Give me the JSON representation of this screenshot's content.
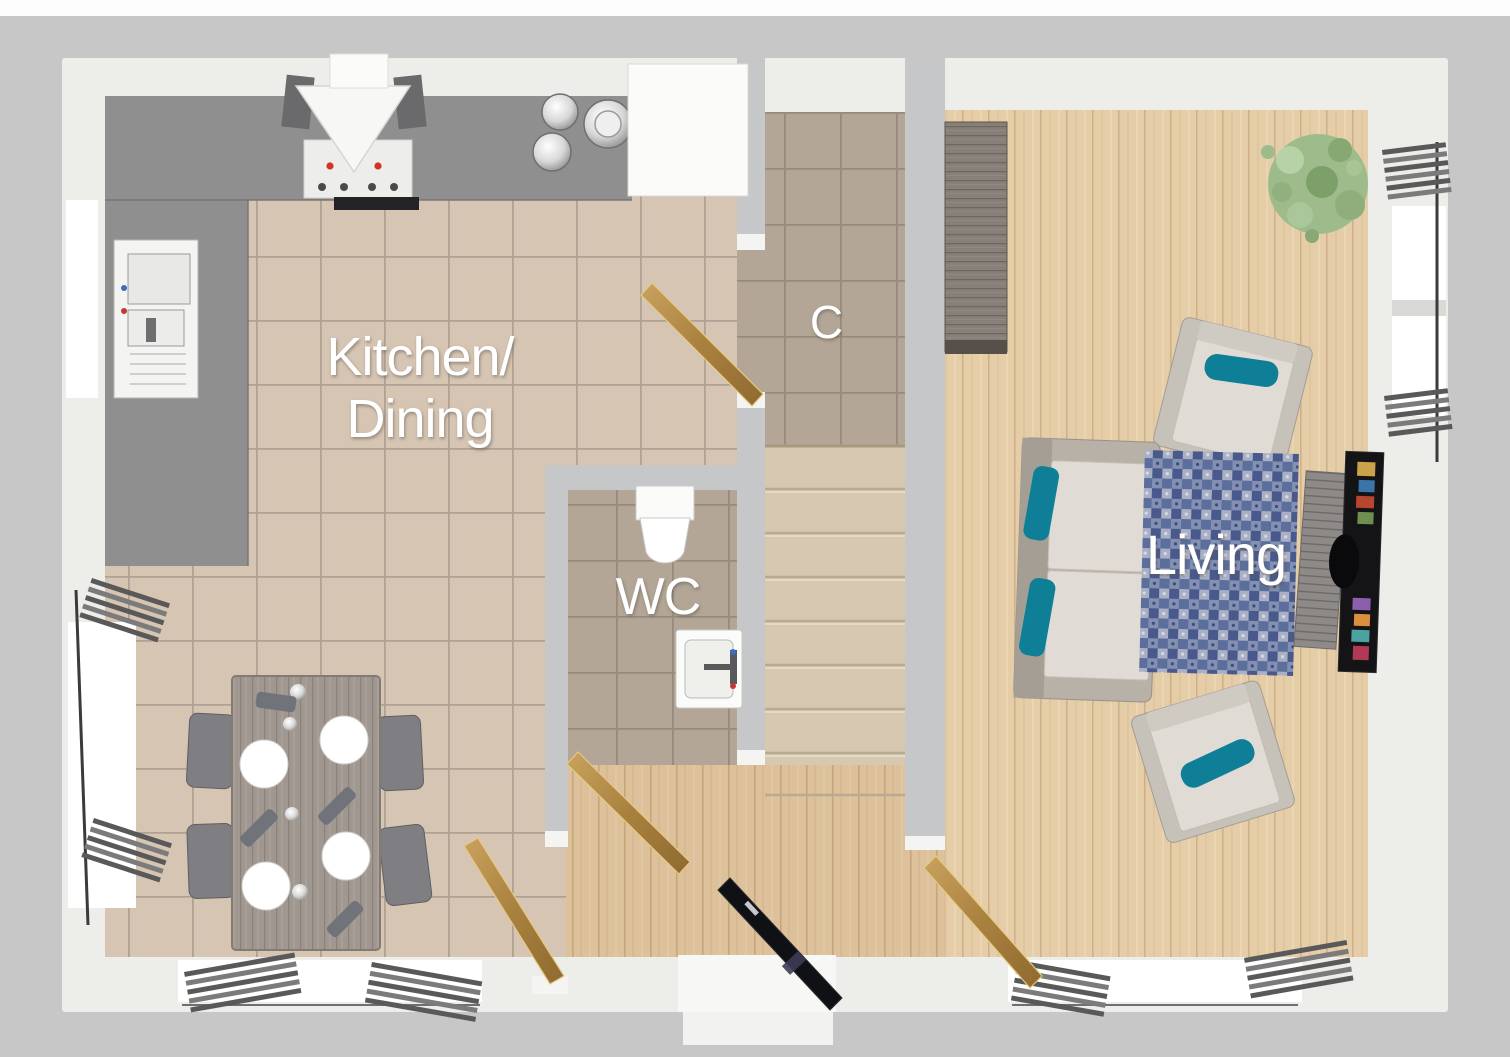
{
  "plan": {
    "view": "3d-top-down-floor-plan",
    "rooms": {
      "kitchen_dining": {
        "label_line1": "Kitchen/",
        "label_line2": "Dining"
      },
      "wc": {
        "label": "WC"
      },
      "cupboard": {
        "label": "C"
      },
      "living": {
        "label": "Living"
      }
    },
    "furniture": {
      "kitchen_dining": [
        "l-shaped-worktop",
        "extractor-hood",
        "hob",
        "sink-bowls",
        "tall-white-cabinet",
        "under-window-sink-unit",
        "dining-table",
        "dining-chairs",
        "plates",
        "radiators",
        "windows"
      ],
      "wc": [
        "toilet",
        "washbasin"
      ],
      "hall": [
        "staircase",
        "front-door",
        "internal-doors"
      ],
      "living": [
        "sofa",
        "armchair",
        "armchair",
        "rug",
        "tv-media-unit",
        "sideboard",
        "plant",
        "radiators",
        "windows"
      ]
    }
  },
  "colors": {
    "ground": "#c7c7c7",
    "top_strip": "#fdfdfd",
    "outer_wall": "#ededea",
    "partition_wall": "#c5c7c9",
    "jamb": "#f4f4f2",
    "kitchen_tile": "#d6c5b3",
    "kitchen_grout": "#a89b8d",
    "wc_tile": "#b3a696",
    "wc_grout": "#94887a",
    "wood_hall": "#dcc19b",
    "wood_living": "#e5cda8",
    "stair_carpet": "#d7c8b1",
    "counter": "#8f8f8f",
    "appliance_white": "#f6f6f4",
    "teal": "#0e7f97",
    "rug_blue": "#5b6e9c",
    "door_wood": "#b9914f",
    "door_wood_dark": "#8f6a2f",
    "front_door": "#101114",
    "radiator": "#595959",
    "plant_green": "#9dbb8b",
    "sideboard_wood": "#878078",
    "sofa_frame": "#b7b1a8",
    "cushion": "#e0dcd5",
    "tv_black": "#141416",
    "label_text": "#ffffff"
  }
}
